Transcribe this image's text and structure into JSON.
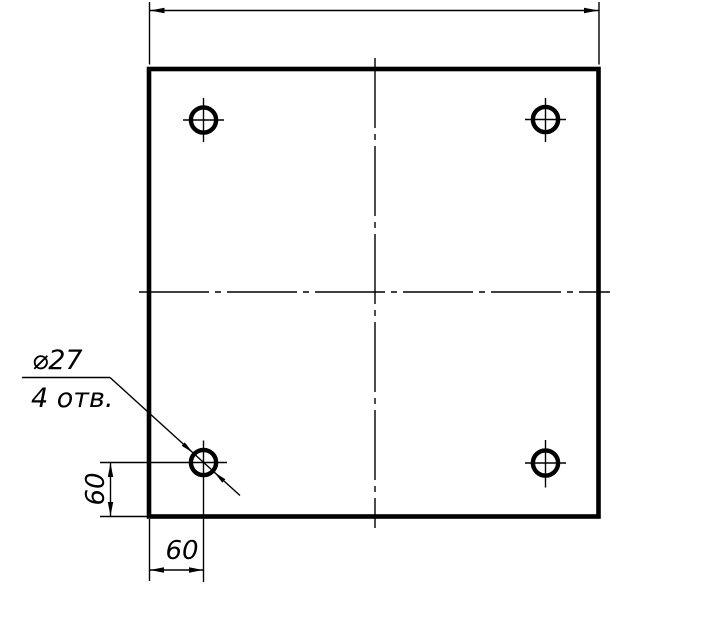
{
  "callout": {
    "diameter": "⌀27",
    "count": "4 отв."
  },
  "dimensions": {
    "hole_offset_left": "60",
    "hole_offset_bottom": "60"
  },
  "colors": {
    "line": "#000000",
    "background": "#ffffff"
  }
}
